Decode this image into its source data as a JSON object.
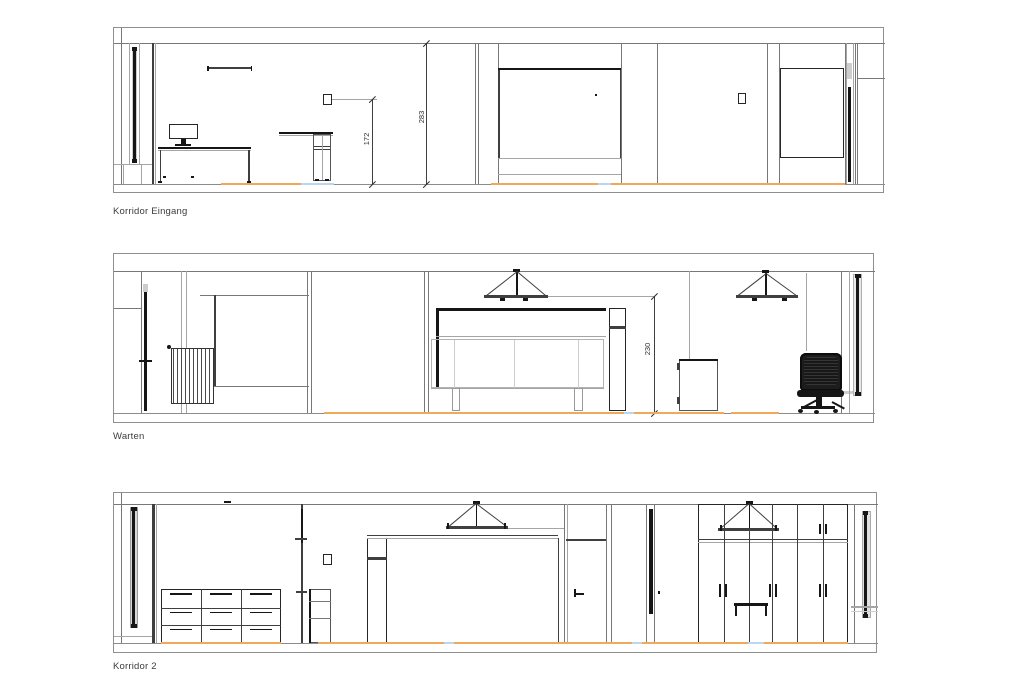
{
  "drawing": {
    "elevations": [
      {
        "label": "Korridor Eingang",
        "dims": {
          "d1": "172",
          "d2": "283"
        }
      },
      {
        "label": "Warten",
        "dims": {
          "d1": "230"
        }
      },
      {
        "label": "Korridor 2",
        "dims": {}
      }
    ],
    "colors": {
      "floor_accent_orange": "#f0a85a",
      "floor_accent_blue": "#b9d7ee",
      "wall_line_gray": "#787878",
      "furniture_dark": "#161616",
      "label_text": "#3c3c3c"
    }
  }
}
